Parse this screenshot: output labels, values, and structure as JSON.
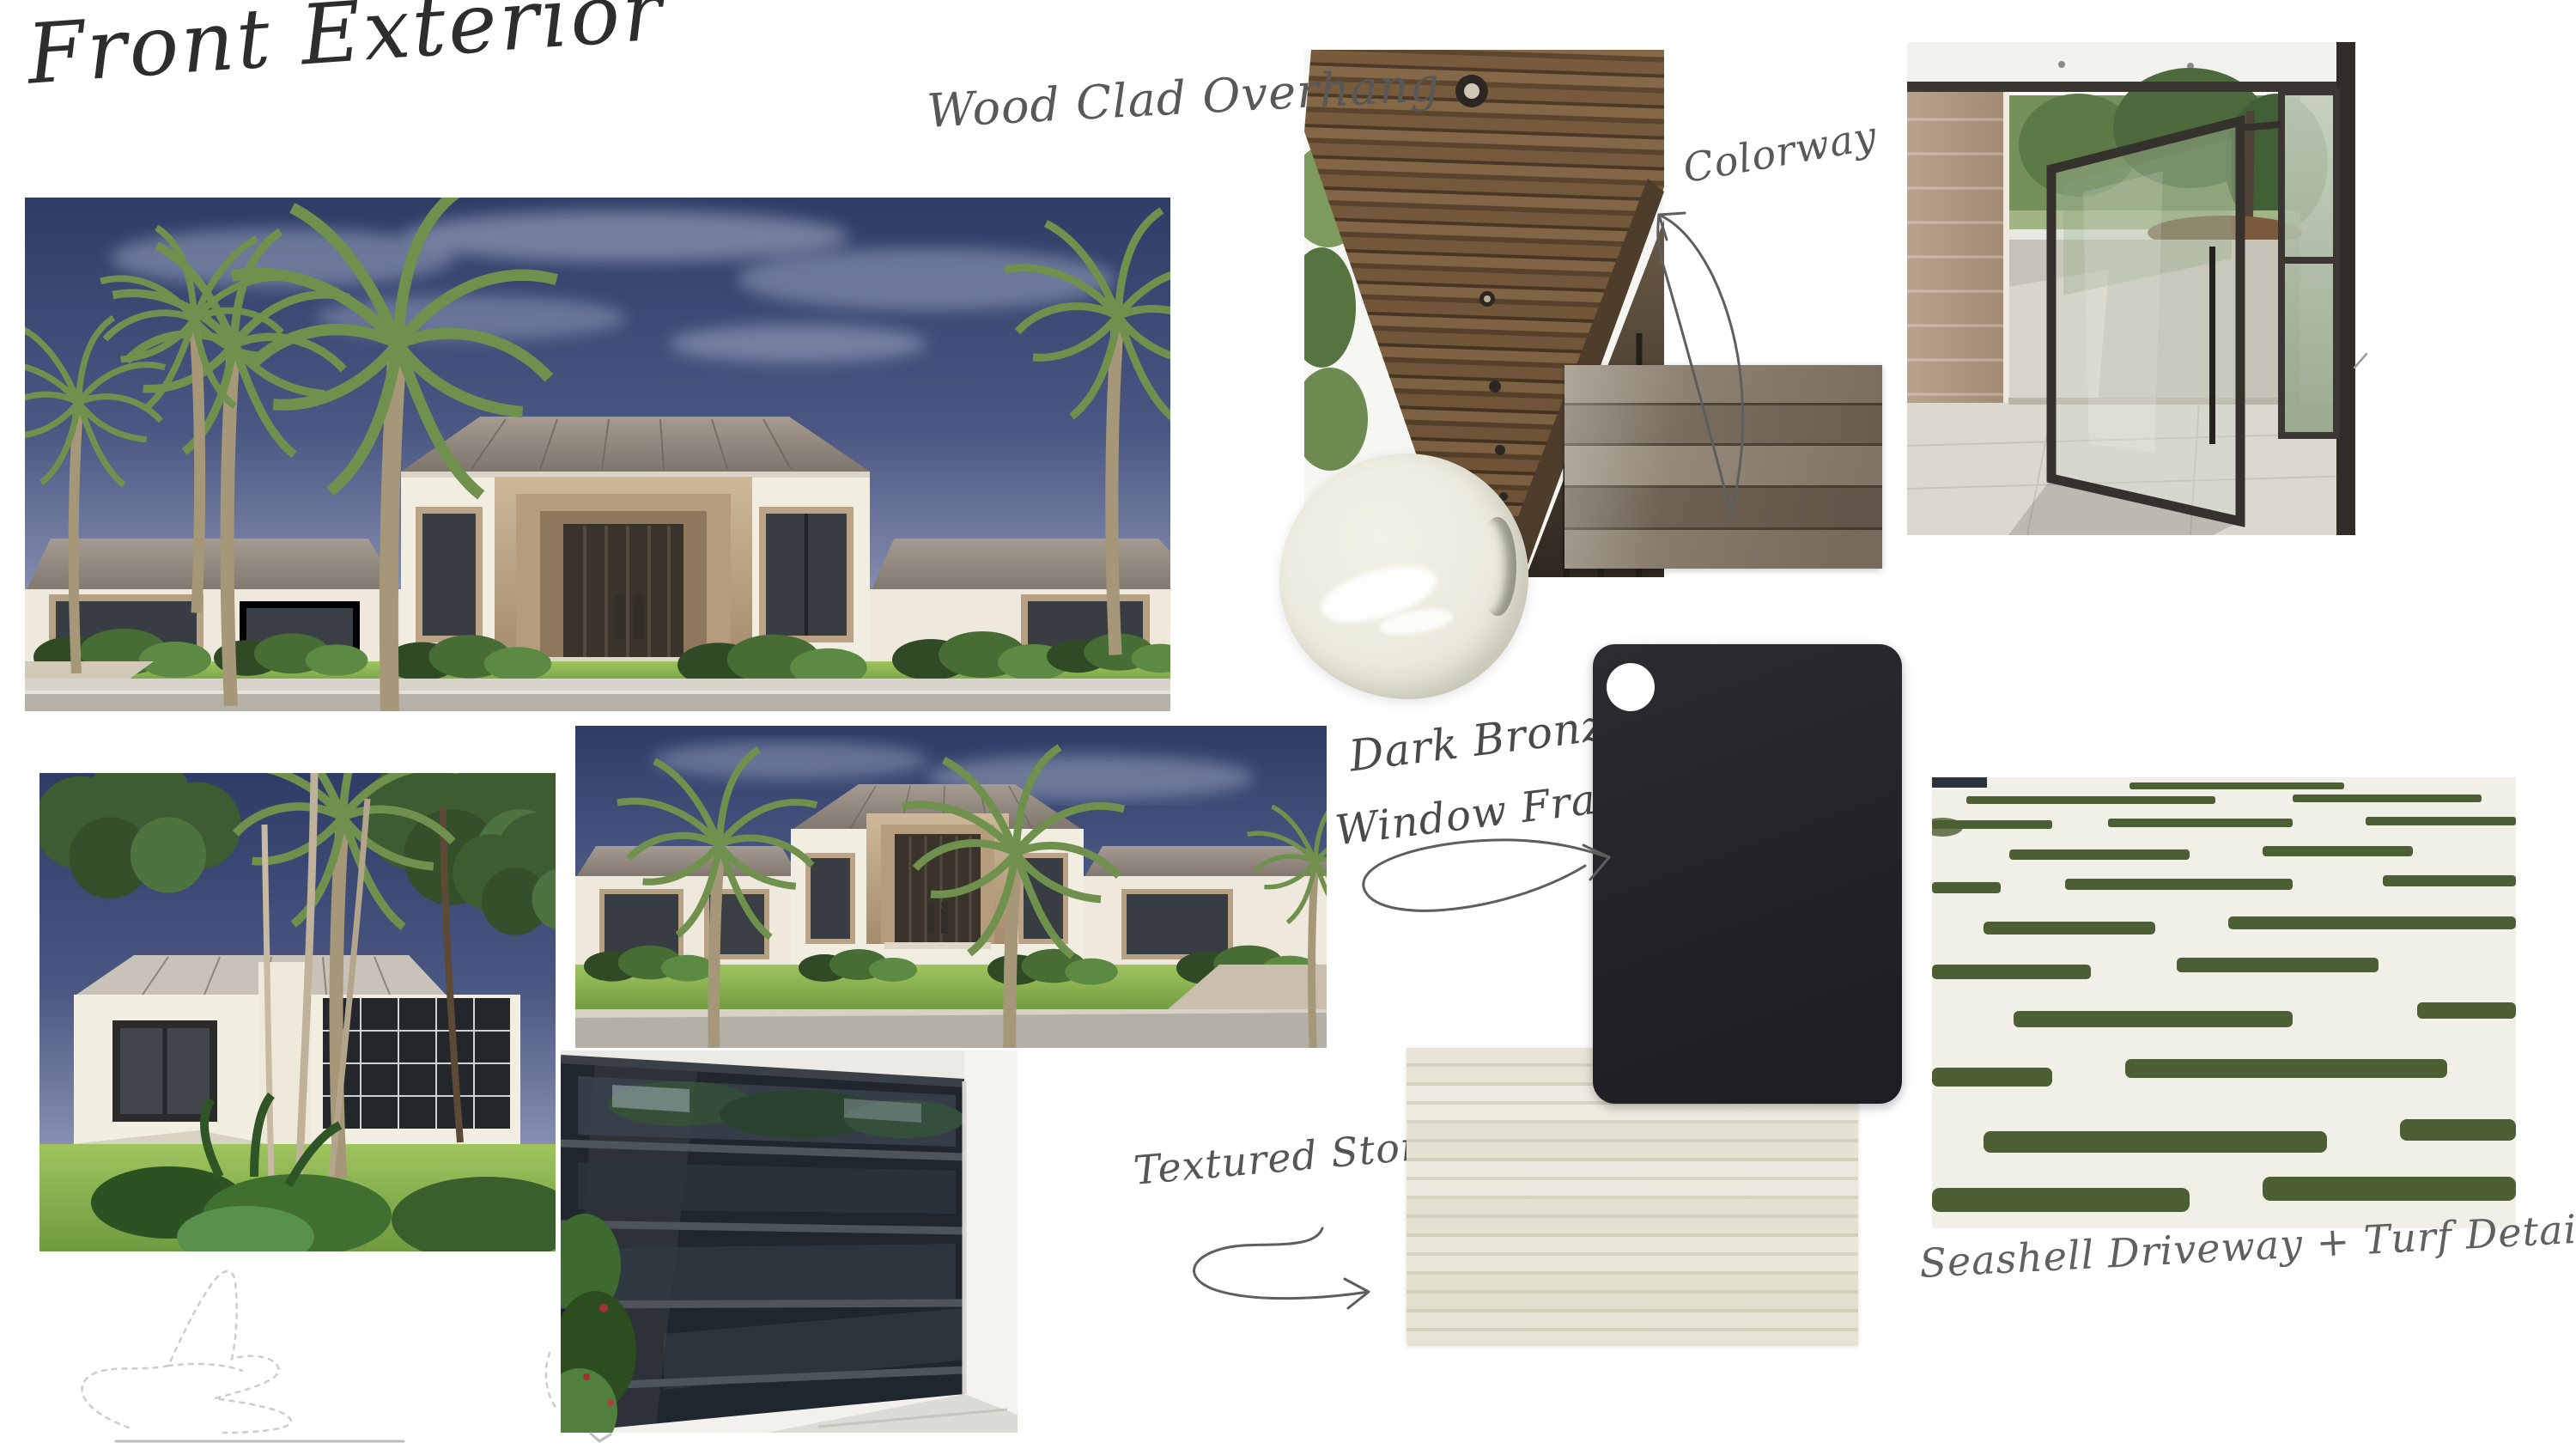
{
  "board": {
    "title": "Front Exterior",
    "background_color": "#FFFFFF",
    "ink_color": "#4F4F4F"
  },
  "annotations": {
    "wood_clad_overhang": "Wood Clad Overhang",
    "colorway": "Colorway",
    "dark_bronze_line1": "Dark Bronze",
    "dark_bronze_line2": "Window Frames",
    "textured_stone": "Textured Stone",
    "seashell_driveway_turf": "Seashell Driveway + Turf Detailing"
  },
  "photos": {
    "main_front_render": "Front exterior rendering - white modern house with wood clad entry and palm trees",
    "side_render": "Side angle exterior rendering with palms and tropical landscaping",
    "second_front_render": "Front elevation rendering with twin palms",
    "garage_door": "Smoked glass garage door with dark bronze frames",
    "wood_overhang": "Wood clad overhang soffit with recessed round lights",
    "pivot_door": "Glass pivot entry door with dark bronze frame and brick side wall",
    "seashell_driveway": "White seashell driveway with green turf detailing strips"
  },
  "swatches": {
    "paint_dollop_color": "#ECEBDE",
    "wood_cladding_color": "#817463",
    "dark_bronze_color": "#26262A",
    "textured_stone_color": "#ECEADF",
    "turf_green_color": "#4C5F33"
  }
}
